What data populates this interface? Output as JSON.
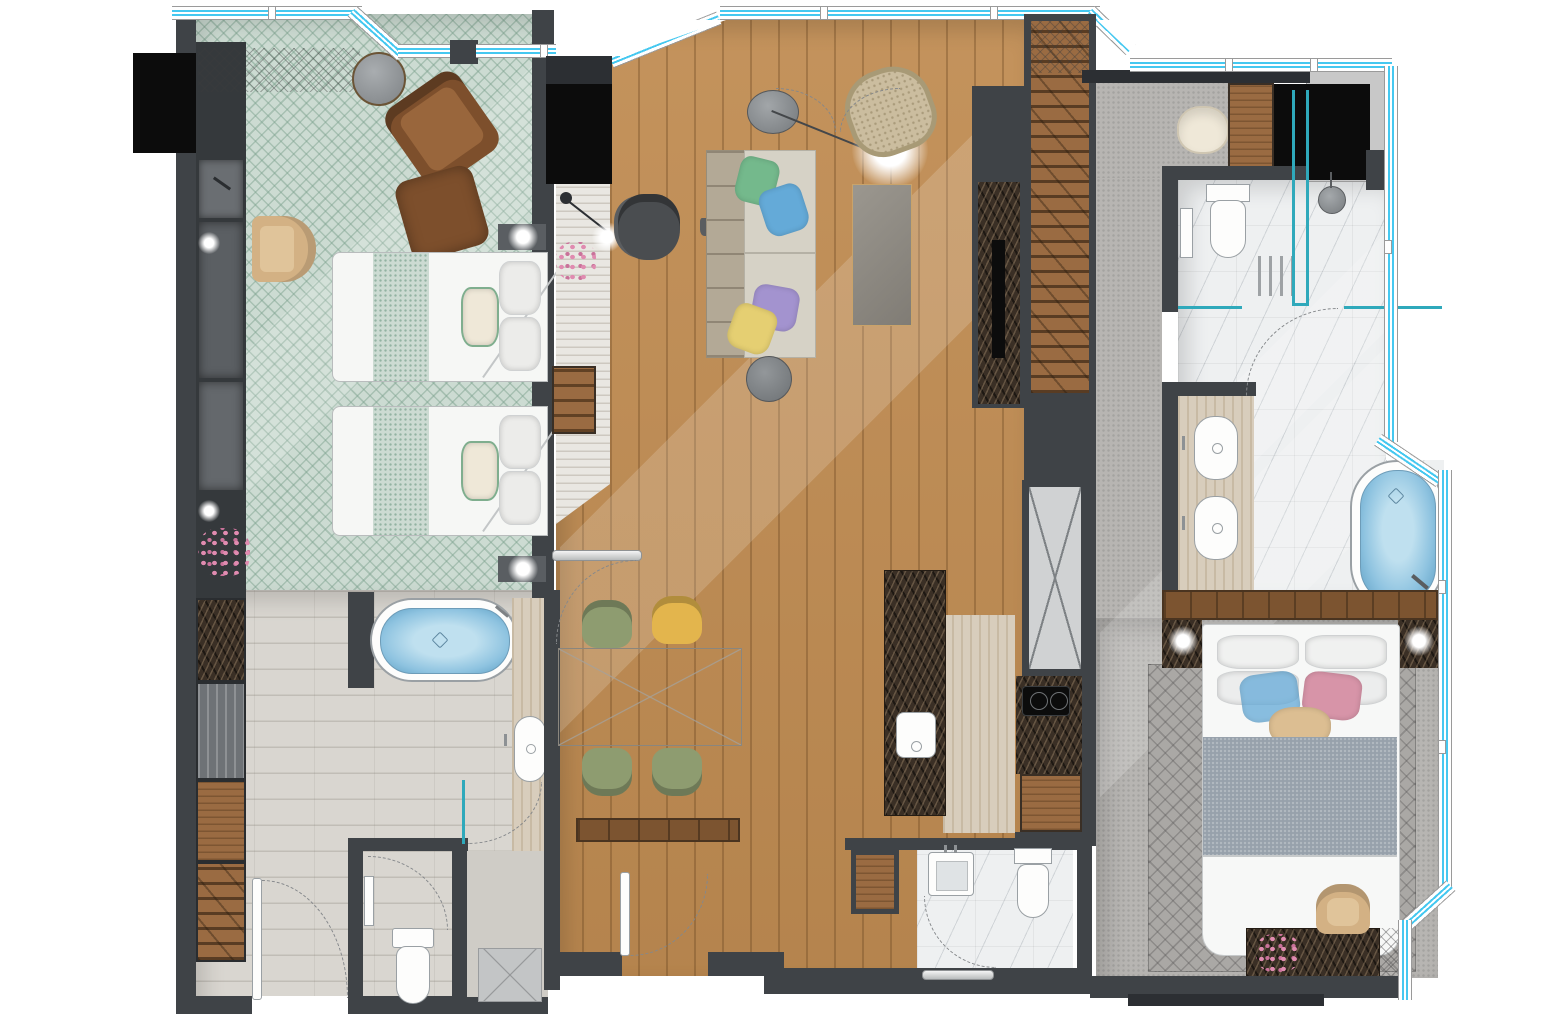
{
  "meta": {
    "canvas_width": 1544,
    "canvas_height": 1030,
    "kind": "hotel-suite-floor-plan-rendering",
    "visible_text": "none"
  },
  "palette": {
    "wall": "#3f4347",
    "wall_dark": "#2c2f33",
    "black": "#0c0c0c",
    "wood": "#c08c52",
    "wood_cab": "#9a6b42",
    "wood_dark": "#7c5430",
    "carpet_green": "#ccdbd2",
    "carpet_gray": "#b7b5b2",
    "rug_gray": "#aaa8a5",
    "travertine": "#d9d6d0",
    "trav_beige": "#d8cdbc",
    "marble_white": "#eef0f1",
    "marble_dark": "#3a2f25",
    "window_cyan": "#45c8f0",
    "glass_teal": "#2fa9bb",
    "water": "#8ec3e0",
    "water_deep": "#5d9fc4",
    "sofa": "#d6d2c6",
    "sofa_back": "#b3a996",
    "table_glass": "#8f8b84",
    "pillow_green": "#74b98c",
    "pillow_blue": "#64aad8",
    "pillow_purple": "#a393cf",
    "pillow_yellow": "#e5cf72",
    "pillow_pink": "#d794a8",
    "pillow_tan": "#dcbe92",
    "chair_brown": "#7d4f2c",
    "chair_tan": "#d3b184",
    "chair_olive": "#8e9c70",
    "chair_yellow": "#e3b54d",
    "office_chair": "#4a4d50",
    "flower_pink": "#e08bb0",
    "fixture_white": "#fdfdfc",
    "ledge_gray": "#c8c8c8",
    "cream": "#efe8d8"
  },
  "rooms": [
    {
      "id": "twin-bedroom",
      "floor": "green patterned carpet",
      "furniture": [
        "round-table",
        "lounge-chair-brown",
        "ottoman-brown",
        "armchair-tan",
        "twin-bed",
        "twin-bed",
        "wall-light",
        "closet-run",
        "flower-arrangement"
      ]
    },
    {
      "id": "twin-bathroom",
      "floor": "travertine tile",
      "furniture": [
        "bathtub",
        "vanity-sink",
        "toilet",
        "shower",
        "storage-cabinets",
        "entry-door"
      ]
    },
    {
      "id": "living-dining",
      "floor": "oak plank",
      "furniture": [
        "writing-desk",
        "desk-chair",
        "sofa",
        "coffee-table",
        "side-table",
        "pendant-lamp",
        "wicker-chair",
        "tv-panel",
        "dining-table",
        "dining-chairs",
        "console-shelf",
        "entry-door"
      ]
    },
    {
      "id": "kitchen",
      "floor": "beige travertine",
      "furniture": [
        "island-with-sink",
        "service-shaft",
        "coffee-counter",
        "base-cabinet"
      ]
    },
    {
      "id": "powder-room",
      "floor": "white marble",
      "furniture": [
        "square-sink",
        "toilet",
        "wood-niche"
      ]
    },
    {
      "id": "corridor-dressing",
      "floor": "gray carpet",
      "furniture": [
        "wardrobe-run",
        "pouf"
      ]
    },
    {
      "id": "master-bathroom",
      "floor": "white marble",
      "furniture": [
        "toilet",
        "shower-glass",
        "shower-head",
        "floor-rack",
        "double-vanity",
        "bathtub",
        "steam-box"
      ]
    },
    {
      "id": "master-bedroom",
      "floor": "gray carpet with lattice rug",
      "furniture": [
        "king-bed",
        "nightstand-left",
        "nightstand-right",
        "headboard-wood-band",
        "writing-desk",
        "desk-chair-tan",
        "flower-arrangement"
      ]
    }
  ],
  "windows": {
    "glazing": "double cyan line in white frame",
    "locations": [
      "top-left run",
      "top-center peaked run",
      "top-right run",
      "right side run with chamfers",
      "bottom-right chamfer"
    ]
  }
}
